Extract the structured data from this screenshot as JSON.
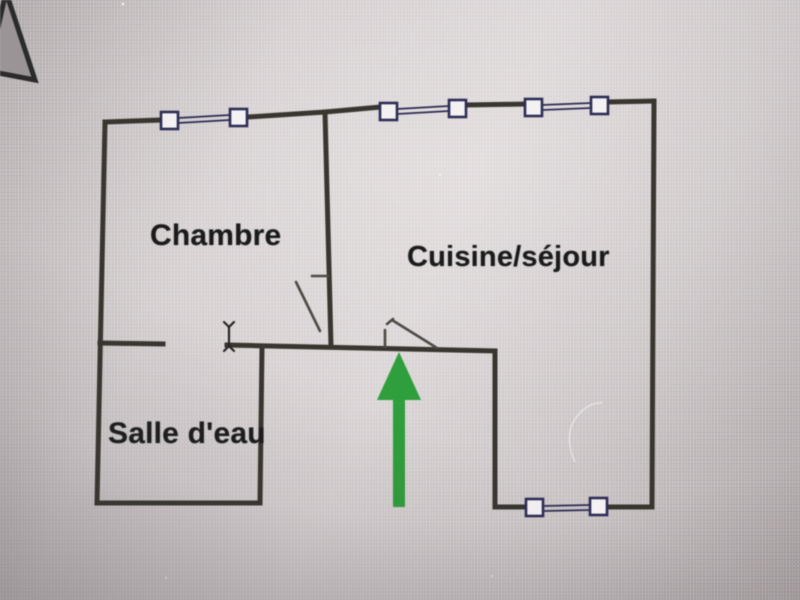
{
  "plan": {
    "title": "apartment floor plan",
    "rooms": [
      {
        "id": "chambre",
        "label": "Chambre"
      },
      {
        "id": "cuisine-sejour",
        "label": "Cuisine/séjour"
      },
      {
        "id": "salle-deau",
        "label": "Salle d'eau"
      }
    ],
    "icons": {
      "entrance_arrow": "green-up-arrow",
      "mouse_cursor": "i-beam-text-cursor",
      "window_symbol": "double-line-window-with-end-squares",
      "door_symbol": "door-leaf-swing",
      "corner_shape": "dark-outlined-triangle"
    },
    "counts": {
      "windows": 4,
      "doors": 2
    }
  },
  "colors": {
    "wall": "#38362f",
    "window": "#2d2c55",
    "window_fill": "#f3f1f2",
    "door": "#4b4a44",
    "arrow": "#2f9e3c",
    "cursor": "#262626",
    "text": "#1b1b1b",
    "triangle_fill": "#9a9497",
    "triangle_stroke": "#2b2b2b"
  }
}
